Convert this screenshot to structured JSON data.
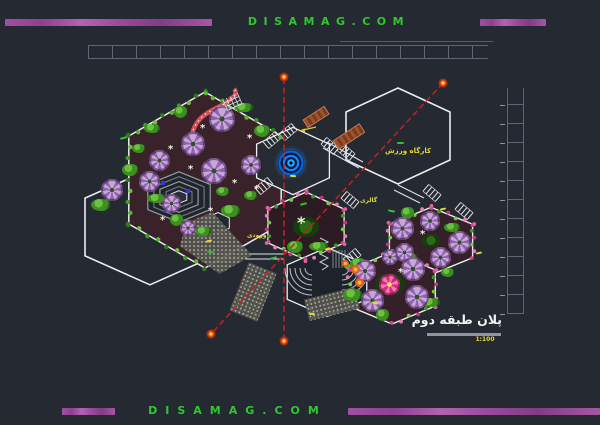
{
  "banner_top": {
    "site": "DISAMAG.COM"
  },
  "banner_bottom": {
    "site": "DISAMAG.COM"
  },
  "title_block": {
    "title": "پلان طبقه دوم",
    "scale": "1:100"
  },
  "colors": {
    "background": "#242932",
    "banner_bar": "#a050a2",
    "banner_text": "#2fc82f",
    "outline_white": "#eceef0",
    "section_line_red": "#c32222",
    "marker_orange": "#ff7b1d",
    "flower_purple": "#c9a6da",
    "flower_pink": "#f02d8a",
    "garden_ground": "#39222a",
    "foliage_green": "#3d8f21",
    "spiral_blue": "#1188ff",
    "label_yellow": "#e6d835"
  },
  "drawing": {
    "hexagons": [
      {
        "cx": 150,
        "cy": 227,
        "r": 75,
        "sy": 0.77,
        "fill": "none",
        "sw": 1.6
      },
      {
        "cx": 205,
        "cy": 180,
        "r": 88,
        "sy": 1.0,
        "fill": "#39222a",
        "sw": 1.5
      },
      {
        "cx": 398,
        "cy": 136,
        "r": 60,
        "sy": 0.8,
        "fill": "none",
        "sw": 1.6
      },
      {
        "cx": 293,
        "cy": 161,
        "r": 42,
        "sy": 0.8,
        "fill": "#262b33",
        "sw": 1.3
      },
      {
        "cx": 306,
        "cy": 226,
        "r": 44,
        "sy": 0.77,
        "fill": "#2c1b22",
        "sw": 1.3
      },
      {
        "cx": 431,
        "cy": 241,
        "r": 48,
        "sy": 0.7,
        "fill": "#351f28",
        "sw": 1.4
      },
      {
        "cx": 392,
        "cy": 288,
        "r": 50,
        "sy": 0.72,
        "fill": "#351f28",
        "sw": 1.4
      },
      {
        "cx": 327,
        "cy": 282,
        "r": 46,
        "sy": 0.75,
        "fill": "#1e232b",
        "sw": 1.3
      },
      {
        "cx": 218,
        "cy": 223,
        "r": 13,
        "sy": 0.8,
        "fill": "#23272e",
        "sw": 1.0
      }
    ],
    "stepped": {
      "cx": 179,
      "cy": 197,
      "sy": 0.7,
      "rings": [
        36,
        29,
        22,
        15
      ],
      "inner": 9
    },
    "corridors": [
      [
        216,
        254,
        284,
        254
      ],
      [
        216,
        259,
        284,
        259
      ],
      [
        363,
        162,
        327,
        142
      ],
      [
        359,
        168,
        323,
        148
      ],
      [
        398,
        185,
        424,
        198
      ],
      [
        394,
        190,
        420,
        203
      ]
    ],
    "red_lines": [
      [
        284,
        78,
        284,
        341
      ],
      [
        443,
        83,
        211,
        334
      ]
    ],
    "markers": [
      [
        284,
        77
      ],
      [
        284,
        341
      ],
      [
        443,
        83
      ],
      [
        211,
        334
      ]
    ],
    "stairs": [
      [
        272,
        140,
        -40
      ],
      [
        288,
        132,
        -40
      ],
      [
        264,
        186,
        -40
      ],
      [
        330,
        146,
        40
      ],
      [
        346,
        152,
        40
      ],
      [
        350,
        200,
        40
      ],
      [
        432,
        193,
        40
      ],
      [
        464,
        211,
        40
      ],
      [
        352,
        257,
        -40
      ]
    ],
    "bead_edges": [
      {
        "p": [
          306,
          192,
          344,
          209
        ],
        "n": 6,
        "pal": "mix"
      },
      {
        "p": [
          344,
          209,
          344,
          243
        ],
        "n": 6,
        "pal": "mix"
      },
      {
        "p": [
          344,
          243,
          306,
          260
        ],
        "n": 6,
        "pal": "mix"
      },
      {
        "p": [
          306,
          260,
          268,
          243
        ],
        "n": 6,
        "pal": "mix"
      },
      {
        "p": [
          268,
          243,
          268,
          209
        ],
        "n": 6,
        "pal": "mix"
      },
      {
        "p": [
          268,
          209,
          306,
          192
        ],
        "n": 6,
        "pal": "mix"
      },
      {
        "p": [
          389,
          224,
          431,
          207
        ],
        "n": 6,
        "pal": "mix"
      },
      {
        "p": [
          431,
          207,
          473,
          224
        ],
        "n": 6,
        "pal": "mix"
      },
      {
        "p": [
          389,
          258,
          389,
          224
        ],
        "n": 6,
        "pal": "mix"
      },
      {
        "p": [
          473,
          224,
          473,
          258
        ],
        "n": 6,
        "pal": "mix"
      },
      {
        "p": [
          349,
          270,
          392,
          252
        ],
        "n": 6,
        "pal": "mix"
      },
      {
        "p": [
          392,
          252,
          435,
          270
        ],
        "n": 6,
        "pal": "mix"
      },
      {
        "p": [
          435,
          270,
          435,
          306
        ],
        "n": 6,
        "pal": "mix"
      },
      {
        "p": [
          435,
          306,
          392,
          324
        ],
        "n": 6,
        "pal": "mix"
      },
      {
        "p": [
          349,
          306,
          349,
          270
        ],
        "n": 6,
        "pal": "mix"
      },
      {
        "p": [
          205,
          92,
          281,
          136
        ],
        "n": 10,
        "pal": "green"
      },
      {
        "p": [
          129,
          136,
          205,
          92
        ],
        "n": 10,
        "pal": "green"
      },
      {
        "p": [
          129,
          224,
          129,
          136
        ],
        "n": 9,
        "pal": "green"
      },
      {
        "p": [
          205,
          268,
          129,
          224
        ],
        "n": 9,
        "pal": "green"
      }
    ],
    "flowers": [
      {
        "x": 222,
        "y": 119,
        "d": 26,
        "t": "p"
      },
      {
        "x": 193,
        "y": 144,
        "d": 24,
        "t": "p"
      },
      {
        "x": 214,
        "y": 171,
        "d": 26,
        "t": "p"
      },
      {
        "x": 159,
        "y": 160,
        "d": 21,
        "t": "p"
      },
      {
        "x": 149,
        "y": 181,
        "d": 21,
        "t": "p"
      },
      {
        "x": 171,
        "y": 203,
        "d": 19,
        "t": "p"
      },
      {
        "x": 112,
        "y": 190,
        "d": 22,
        "t": "p"
      },
      {
        "x": 251,
        "y": 165,
        "d": 20,
        "t": "p"
      },
      {
        "x": 188,
        "y": 228,
        "d": 16,
        "t": "p"
      },
      {
        "x": 402,
        "y": 228,
        "d": 23,
        "t": "p"
      },
      {
        "x": 430,
        "y": 221,
        "d": 20,
        "t": "p"
      },
      {
        "x": 459,
        "y": 242,
        "d": 23,
        "t": "p"
      },
      {
        "x": 440,
        "y": 257,
        "d": 21,
        "t": "p"
      },
      {
        "x": 404,
        "y": 252,
        "d": 19,
        "t": "p"
      },
      {
        "x": 365,
        "y": 271,
        "d": 22,
        "t": "p"
      },
      {
        "x": 413,
        "y": 269,
        "d": 24,
        "t": "p"
      },
      {
        "x": 417,
        "y": 297,
        "d": 24,
        "t": "p"
      },
      {
        "x": 372,
        "y": 300,
        "d": 23,
        "t": "p"
      },
      {
        "x": 390,
        "y": 257,
        "d": 16,
        "t": "p"
      },
      {
        "x": 389,
        "y": 284,
        "d": 21,
        "t": "k"
      },
      {
        "x": 355,
        "y": 269,
        "d": 9,
        "t": "o"
      },
      {
        "x": 359,
        "y": 282,
        "d": 9,
        "t": "o"
      },
      {
        "x": 345,
        "y": 263,
        "d": 7,
        "t": "o"
      }
    ],
    "bushes": [
      [
        138,
        148
      ],
      [
        130,
        170
      ],
      [
        156,
        198
      ],
      [
        176,
        220
      ],
      [
        203,
        231
      ],
      [
        230,
        211
      ],
      [
        250,
        195
      ],
      [
        262,
        131
      ],
      [
        243,
        107
      ],
      [
        180,
        112
      ],
      [
        152,
        128
      ],
      [
        100,
        205
      ],
      [
        222,
        191
      ],
      [
        295,
        247
      ],
      [
        318,
        246
      ],
      [
        407,
        213
      ],
      [
        452,
        227
      ],
      [
        414,
        266
      ],
      [
        447,
        272
      ],
      [
        358,
        264
      ],
      [
        430,
        302
      ],
      [
        382,
        315
      ],
      [
        409,
        257
      ],
      [
        352,
        295
      ]
    ],
    "mounds": [
      [
        431,
        240,
        18,
        13
      ],
      [
        306,
        227,
        26,
        20
      ],
      [
        390,
        284,
        30,
        22
      ]
    ],
    "speckles": [
      {
        "x": 180,
        "y": 212,
        "w": 72,
        "h": 62,
        "rot": 0,
        "clip": "polygon(8% 18%,45% 0%,100% 70%,55% 100%,0% 55%)"
      },
      {
        "x": 238,
        "y": 266,
        "w": 30,
        "h": 52,
        "rot": 22,
        "clip": ""
      },
      {
        "x": 306,
        "y": 293,
        "w": 52,
        "h": 22,
        "rot": -14,
        "clip": ""
      }
    ],
    "ramps": [
      [
        333,
        131,
        30,
        9,
        -33
      ],
      [
        303,
        112,
        24,
        8,
        -33
      ]
    ],
    "spiral": [
      291,
      163,
      26
    ],
    "grid": [
      224,
      96,
      17,
      12,
      -24
    ],
    "winding": "M197,154 C187,140 193,126 201,118 C210,109 224,106 231,99 C236,95 237,92 234,89",
    "zigzag": "320,238 328,242 320,246 328,250 320,254 328,258 320,262 328,266 322,270",
    "hatch": {
      "x0": 333,
      "x1": 345,
      "step": 3,
      "y0": 250,
      "y1": 268
    },
    "fans": [
      {
        "cx": 312,
        "cy": 268,
        "dir": "l"
      },
      {
        "cx": 342,
        "cy": 268,
        "dir": "r"
      }
    ],
    "fan_radii": [
      7,
      12,
      17,
      22,
      27
    ],
    "blue_squares": [
      [
        161,
        181
      ],
      [
        186,
        189
      ],
      [
        164,
        208
      ]
    ],
    "yellow_arrow": {
      "line": [
        316,
        127,
        303,
        130
      ],
      "head": [
        299,
        130.5
      ]
    },
    "labels": [
      {
        "text": "کارگاه ورزش",
        "x": 385,
        "y": 147,
        "s": 7
      },
      {
        "text": "گالری",
        "x": 360,
        "y": 197,
        "s": 6
      },
      {
        "text": "ورودی",
        "x": 247,
        "y": 232,
        "s": 6
      }
    ],
    "accents_yellow": [
      [
        325,
        248
      ],
      [
        440,
        208
      ],
      [
        476,
        252
      ],
      [
        206,
        240
      ],
      [
        290,
        175
      ],
      [
        309,
        313
      ],
      [
        372,
        302
      ]
    ],
    "accents_green": [
      [
        120,
        137
      ],
      [
        397,
        142
      ],
      [
        388,
        210
      ],
      [
        270,
        257
      ],
      [
        207,
        251
      ],
      [
        345,
        266
      ],
      [
        300,
        203
      ]
    ],
    "sparkles": [
      [
        200,
        126
      ],
      [
        168,
        147
      ],
      [
        188,
        167
      ],
      [
        232,
        181
      ],
      [
        254,
        187
      ],
      [
        208,
        209
      ],
      [
        247,
        136
      ],
      [
        160,
        218
      ],
      [
        420,
        232
      ],
      [
        398,
        270
      ]
    ],
    "plant": [
      297,
      218
    ]
  }
}
